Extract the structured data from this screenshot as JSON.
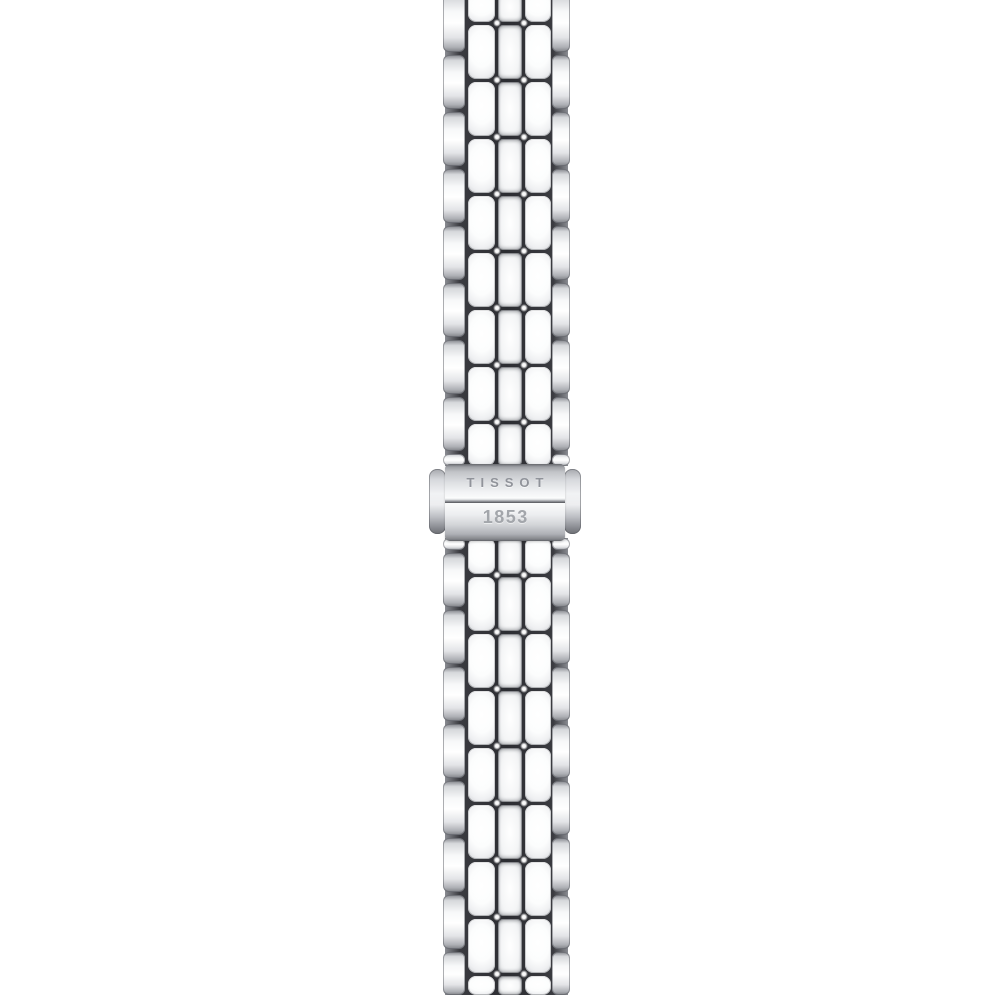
{
  "scene": {
    "type": "product-photo",
    "subject": "Stainless steel watch bracelet with folding clasp",
    "background_color": "#ffffff"
  },
  "clasp": {
    "brand": "TISSOT",
    "year": "1853",
    "engraving_color": "#90939a",
    "metal_color": "#d5d7da"
  },
  "strap": {
    "left": 443,
    "width": 127,
    "row_pitch": 57,
    "gap": 3,
    "columns": [
      {
        "name": "outer-left",
        "left": 0,
        "width": 22,
        "style": "outer",
        "phase": "outer"
      },
      {
        "name": "center-left",
        "left": 25,
        "width": 27,
        "style": "pillow",
        "phase": "center"
      },
      {
        "name": "middle",
        "left": 55,
        "width": 24,
        "style": "mid",
        "phase": "center"
      },
      {
        "name": "center-right",
        "left": 82,
        "width": 26,
        "style": "pillow",
        "phase": "center"
      },
      {
        "name": "outer-right",
        "left": 109,
        "width": 18,
        "style": "outer",
        "phase": "outer"
      }
    ],
    "segments": [
      {
        "name": "upper",
        "y0": 0,
        "y1": 466,
        "center_start": 23,
        "outer_start": 53
      },
      {
        "name": "lower",
        "y0": 538,
        "y1": 995,
        "center_start": 575,
        "outer_start": 551
      }
    ],
    "sparkle_x": [
      53.5,
      80.5
    ],
    "colors": {
      "metal_highlight": "#ffffff",
      "metal_mid": "#d6d8db",
      "metal_shadow": "#86888e",
      "gap_dark": "#2c2d32"
    }
  }
}
